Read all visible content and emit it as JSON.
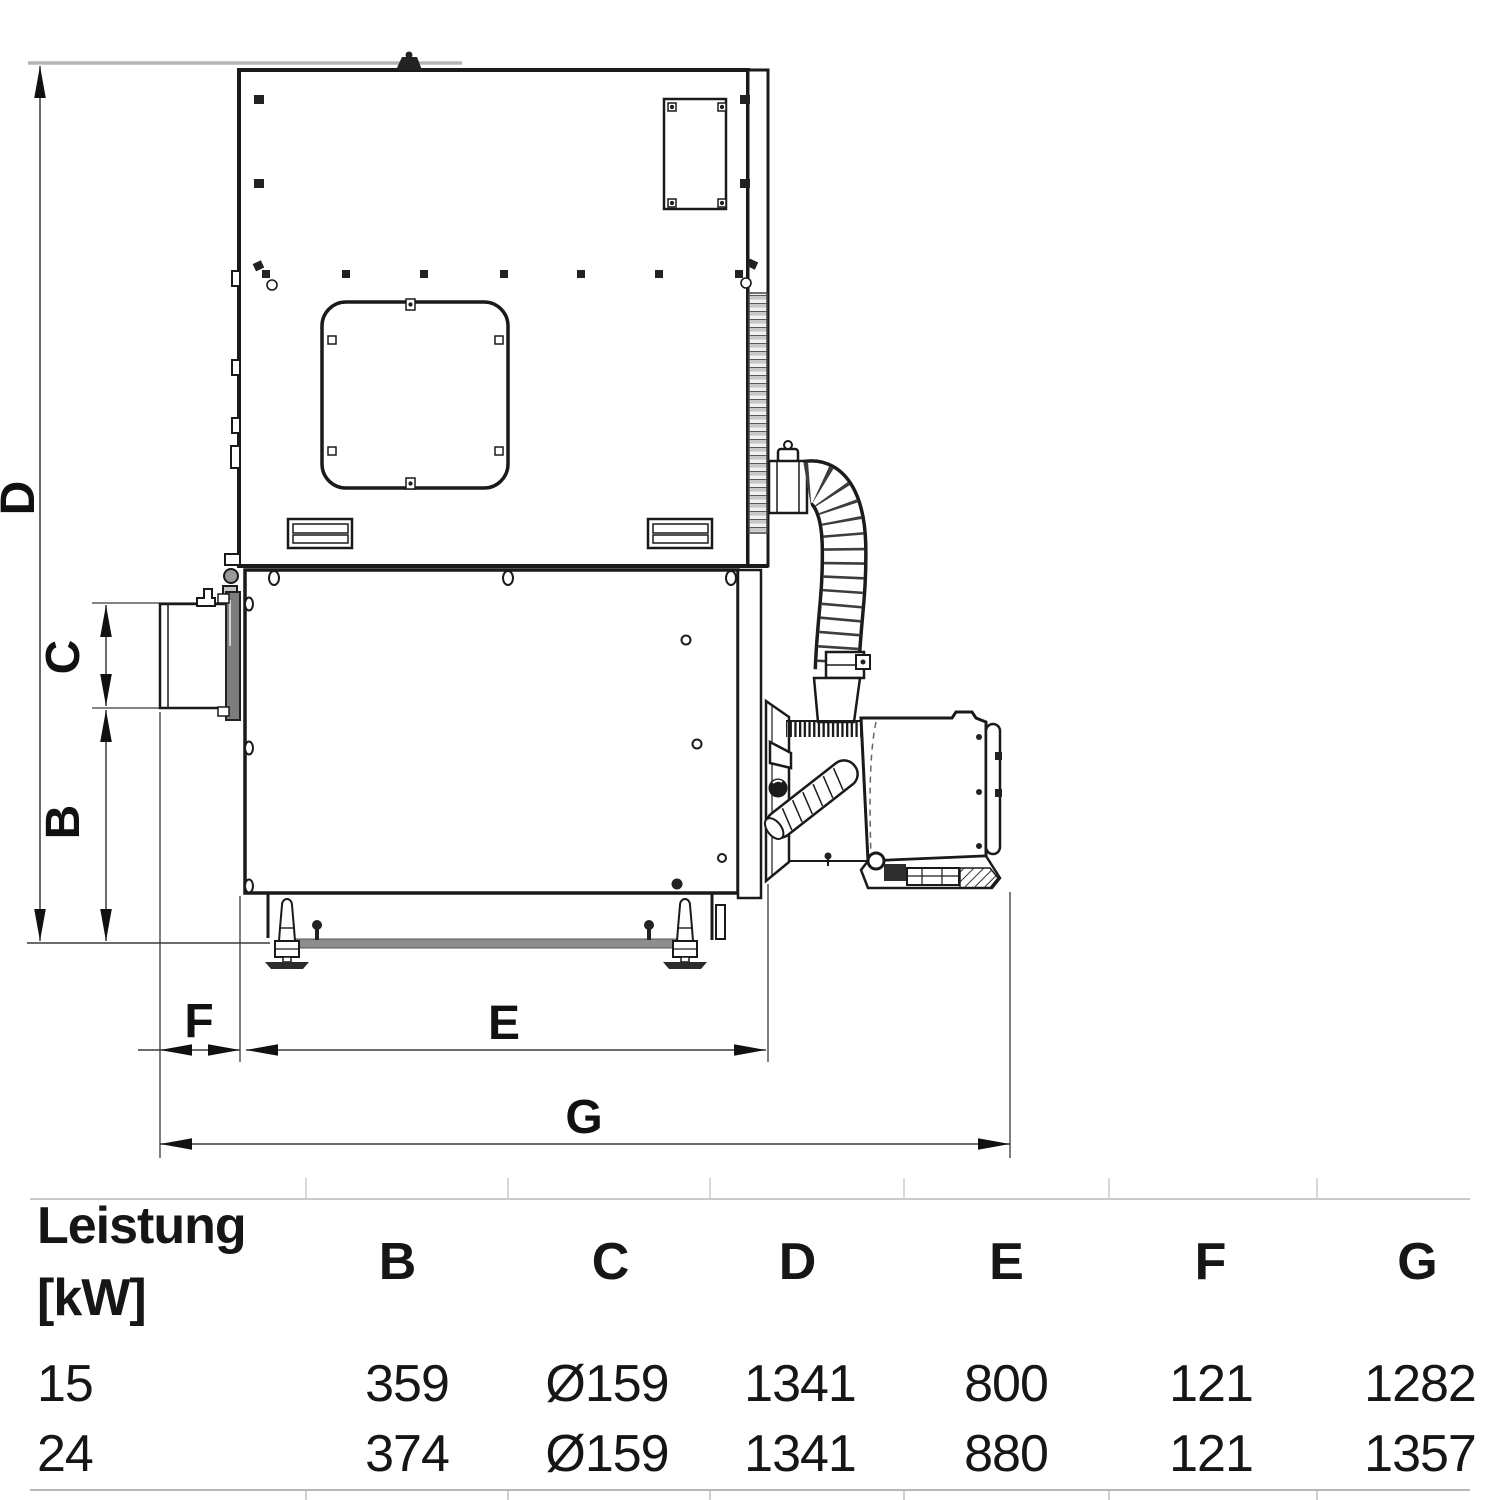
{
  "diagram": {
    "dimension_labels": {
      "D": "D",
      "C": "C",
      "B": "B",
      "F": "F",
      "E": "E",
      "G": "G"
    }
  },
  "table": {
    "power_header": {
      "line1": "Leistung",
      "line2": "[kW]"
    },
    "dim_headers": [
      "B",
      "C",
      "D",
      "E",
      "F",
      "G"
    ],
    "rows": [
      {
        "power_kw": "15",
        "values": [
          "359",
          "Ø159",
          "1341",
          "800",
          "121",
          "1282"
        ]
      },
      {
        "power_kw": "24",
        "values": [
          "374",
          "Ø159",
          "1341",
          "880",
          "121",
          "1357"
        ]
      }
    ]
  }
}
